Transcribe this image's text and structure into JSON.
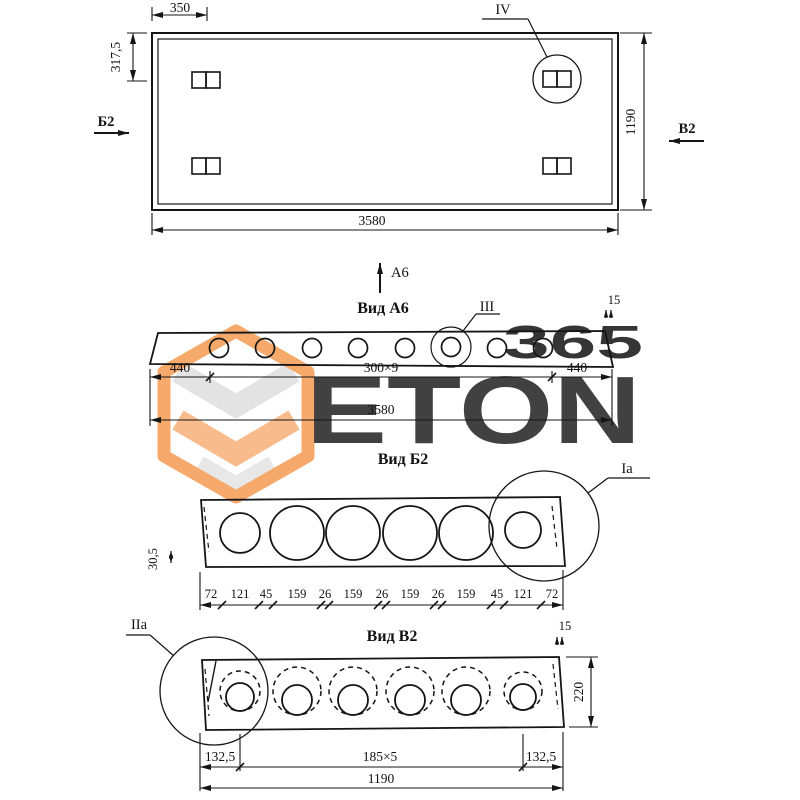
{
  "watermark": {
    "number": "365",
    "brand": "ETON",
    "accent_color": "#ee8040",
    "gray_color": "#d9d9d9"
  },
  "plan": {
    "dim_loop_x": "350",
    "dim_loop_y": "317,5",
    "dim_height": "1190",
    "dim_length": "3580",
    "section_left": "Б2",
    "section_right": "B2",
    "detail_label": "IV"
  },
  "view_a6": {
    "direction_label": "А6",
    "title": "Вид А6",
    "detail_label": "III",
    "gap": "15",
    "dim_left": "440",
    "dim_mid": "300×9",
    "dim_right": "440",
    "dim_total": "3580"
  },
  "view_b2": {
    "title": "Вид Б2",
    "detail_label": "Ia",
    "dim_flange": "30,5",
    "chain": [
      "72",
      "121",
      "45",
      "159",
      "26",
      "159",
      "26",
      "159",
      "26",
      "159",
      "45",
      "121",
      "72"
    ]
  },
  "view_v2": {
    "title": "Вид В2",
    "detail_label": "IIa",
    "gap": "15",
    "dim_height": "220",
    "dim_left": "132,5",
    "dim_mid": "185×5",
    "dim_right": "132,5",
    "dim_total": "1190"
  }
}
